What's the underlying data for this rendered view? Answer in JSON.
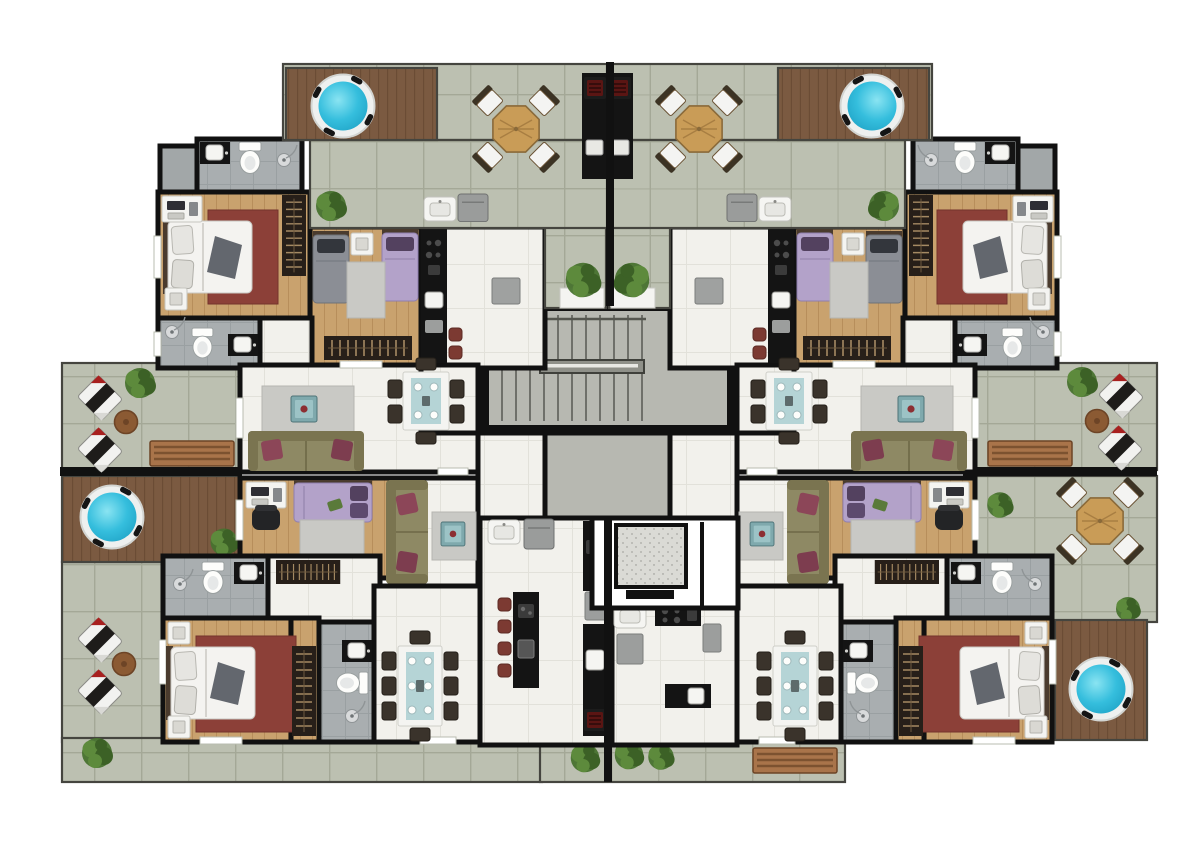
{
  "meta": {
    "kind": "architectural-floor-plan",
    "style": "top-down 3D furnished render",
    "text_visible": false
  },
  "palette": {
    "wall": "#111111",
    "terrace": "#bcc0b1",
    "terrace_line": "#a4a897",
    "deck": "#7b5a41",
    "deck_line": "#664832",
    "floor": "#f2f1ec",
    "floor_line": "#e2e1da",
    "wood": "#c9a26e",
    "wood_line": "#b78e5b",
    "bath": "#a9aeb0",
    "bath_line": "#9aa0a2",
    "concrete": "#b7b8b1",
    "water": "#35bedd",
    "water_deep": "#1fa3c6",
    "water_light": "#8ae4f2",
    "counter": "#141414",
    "granite": "#dadad5",
    "sofa": "#8e8964",
    "sofa_dark": "#7a7450",
    "pillow": "#8c4658",
    "rug_red": "#8c4038",
    "rug_gray": "#c9c9c5",
    "bed_purple": "#b3a2c9",
    "bed_purple_dark": "#53415f",
    "bed_gray": "#8b8e95",
    "bed_gray_dark": "#33363c",
    "glass_teal": "#b5d4d6",
    "table_wood": "#c99c57",
    "bench_wood": "#a9744a",
    "stool_red": "#7c3a32",
    "plant_a": "#48722f",
    "plant_b": "#5d8a3c",
    "plant_c": "#3c6126",
    "white_fixture": "#f5f5f2"
  },
  "plan": {
    "core": [
      "staircase",
      "elevator",
      "elevator-lobby",
      "planter-boxes"
    ],
    "symmetry": "mirrored left-right about central divider wall",
    "units": [
      {
        "id": "upper-left",
        "rooms": [
          "roof-terrace-with-plunge-pool",
          "bbq-counter",
          "outdoor-dining",
          "bathroom-1",
          "storage",
          "master-bedroom",
          "twin-bedroom",
          "bathroom-2",
          "kitchen",
          "entry-hall",
          "living-dining",
          "second-bedroom",
          "tv-living"
        ]
      },
      {
        "id": "upper-right",
        "rooms": [
          "roof-terrace-with-plunge-pool",
          "bbq-counter",
          "outdoor-dining",
          "bathroom-1",
          "storage",
          "master-bedroom",
          "twin-bedroom",
          "bathroom-2",
          "kitchen",
          "entry-hall",
          "living-dining",
          "second-bedroom",
          "tv-living"
        ]
      },
      {
        "id": "lower-left",
        "rooms": [
          "terrace-with-jacuzzi-deck",
          "lounge-terrace",
          "bathroom-3",
          "master-bedroom",
          "wardrobe",
          "bathroom-4",
          "dining-8",
          "island-kitchen"
        ]
      },
      {
        "id": "lower-right",
        "rooms": [
          "terrace-with-outdoor-dining",
          "jacuzzi-deck",
          "bathroom-3",
          "master-bedroom",
          "wardrobe",
          "bathroom-4",
          "dining-8",
          "kitchen"
        ]
      }
    ],
    "amenities": [
      "plunge-pools",
      "sun-loungers",
      "wood-benches",
      "octagonal-outdoor-tables",
      "barbecue-grills",
      "planters"
    ]
  },
  "counts": {
    "plunge_pools": 4,
    "outdoor_octagonal_tables": 3,
    "sun_loungers": 6,
    "wood_benches": 3,
    "double_beds": 6,
    "single_beds": 4,
    "sofas": 4,
    "indoor_dining_tables": 4,
    "toilets": 8,
    "kitchens": 4,
    "staircases": 1,
    "elevators": 1,
    "plants": 14
  }
}
